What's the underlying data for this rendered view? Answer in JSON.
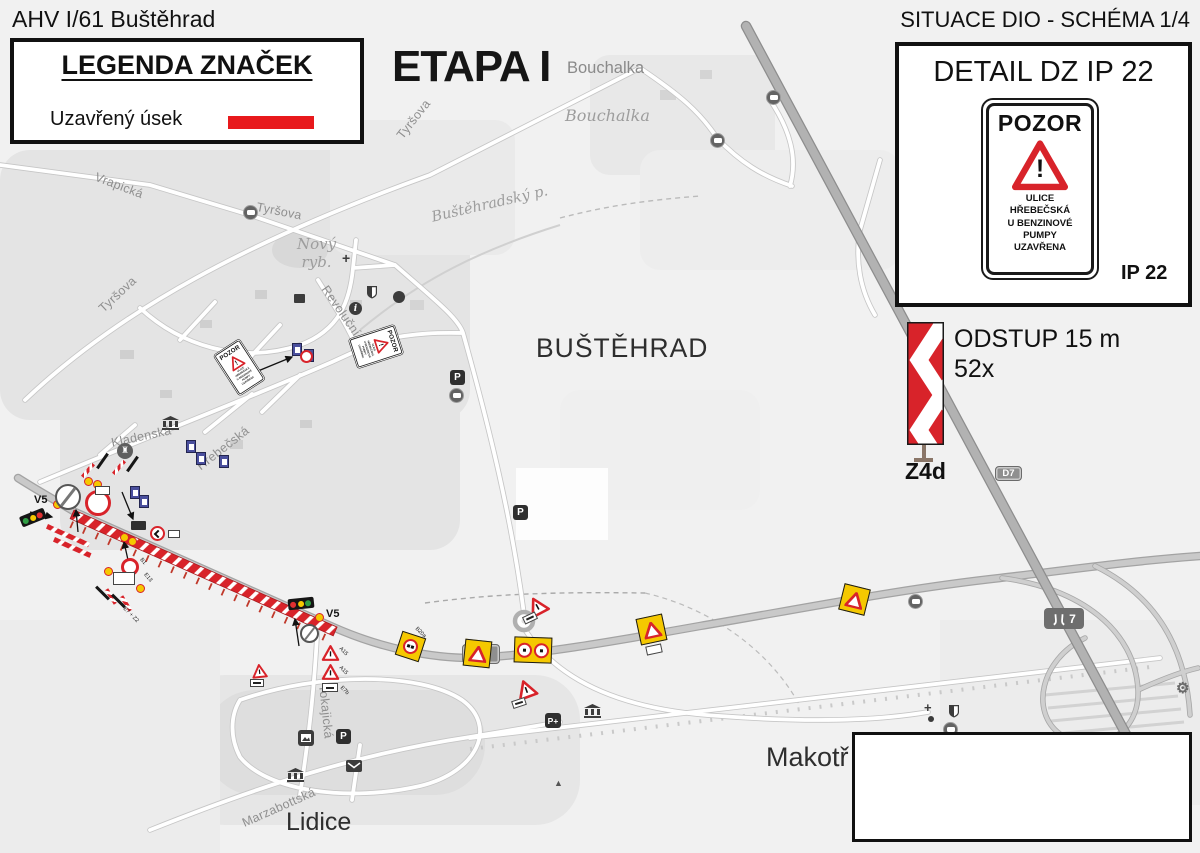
{
  "header": {
    "left_title": "AHV I/61 Buštěhrad",
    "right_title": "SITUACE DIO - SCHÉMA 1/4"
  },
  "legend": {
    "title": "LEGENDA ZNAČEK",
    "closed_section_label": "Uzavřený úsek"
  },
  "stage": {
    "label": "ETAPA I"
  },
  "detail_panel": {
    "title": "DETAIL DZ IP 22",
    "code": "IP 22",
    "sign": {
      "header": "POZOR",
      "exclamation": "!",
      "lines": [
        "ULICE",
        "HŘEBEČSKÁ",
        "U BENZINOVÉ",
        "PUMPY",
        "UZAVŘENA"
      ]
    }
  },
  "z4d": {
    "label": "Z4d",
    "offset_note": "ODSTUP 15 m",
    "count_note": "52x"
  },
  "shields": {
    "road61": "61",
    "d7": "D7",
    "motorway7": "7"
  },
  "places": {
    "bustehrad": "BUŠTĚHRAD",
    "lidice": "Lidice",
    "makotrasy": "Makotř",
    "bouchalka": "Bouchalka",
    "bouchalka_small": "Bouchalka",
    "novy_rybnik": "Nový\nryb.",
    "bustehradsky_potok": "Buštěhradský p."
  },
  "streets": {
    "vrapicka": "Vrapická",
    "tyrsova_a": "Tyršova",
    "tyrsova_b": "Tyršova",
    "tyrsova_c": "Tyršova",
    "revolucni": "Revoluční",
    "kladenska": "Kladenská",
    "hrebecska": "Hřebečská",
    "tokajicka": "Tokajická",
    "marzabottska": "Marzabottská"
  },
  "markers": {
    "v5_a": "V5",
    "v5_b": "V5"
  },
  "sign_codes": {
    "b1": "B1",
    "e13": "E13",
    "e7_z2": "E7 + Z2",
    "a15_a": "A15",
    "a15_b": "A15",
    "e7b": "E7b",
    "b20a": "B20a"
  },
  "icons": {
    "info_glyph": "i",
    "gear_glyph": "⚙",
    "castle_glyph": "♜",
    "monument_glyph": "▲",
    "cross_glyph": "+",
    "parking_glyph": "P",
    "parking_plus_glyph": "P+"
  },
  "colors": {
    "closed_red": "#d8232a",
    "accent_red": "#e8191c",
    "board_yellow": "#f5c800",
    "blue_sign": "#4a4f9d",
    "map_bg": "#f1f1f1"
  }
}
